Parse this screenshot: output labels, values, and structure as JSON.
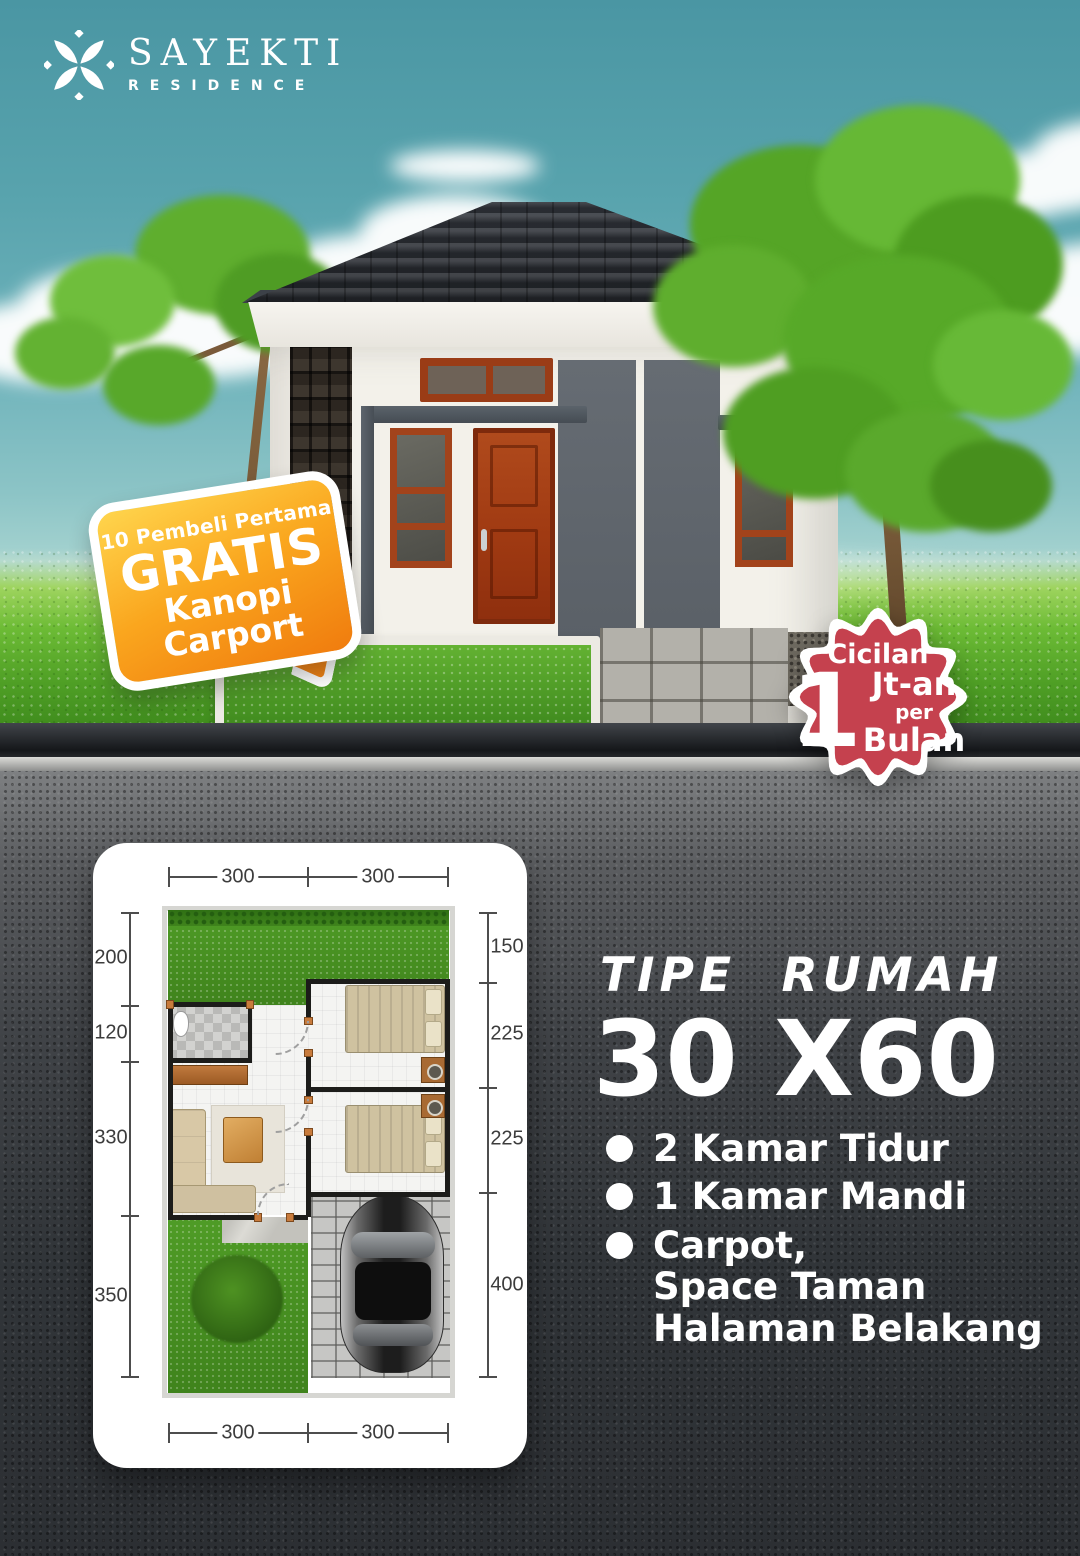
{
  "brand": {
    "name": "SAYEKTI",
    "subtitle": "RESIDENCE"
  },
  "promo_badge": {
    "line1": "10 Pembeli Pertama",
    "line2": "GRATIS",
    "line3": "Kanopi",
    "line4": "Carport"
  },
  "installment_badge": {
    "label": "Cicilan",
    "amount": "1",
    "unit": "Jt-an",
    "per": "per",
    "period": "Bulan"
  },
  "type_info": {
    "heading": "TIPE RUMAH",
    "size": "30 X60",
    "features": [
      "2 Kamar Tidur",
      "1 Kamar Mandi",
      "Carpot,\nSpace Taman\nHalaman Belakang"
    ]
  },
  "floorplan": {
    "dims_top": [
      "300",
      "300"
    ],
    "dims_bottom": [
      "300",
      "300"
    ],
    "dims_left": [
      "200",
      "120",
      "330",
      "350"
    ],
    "dims_right": [
      "150",
      "225",
      "225",
      "400"
    ]
  },
  "colors": {
    "sky_teal": "#5fa8b2",
    "grass_green": "#5aaa2c",
    "asphalt_dark": "#303337",
    "promo_orange": "#f7941d",
    "installment_red": "#c5414e",
    "wood_brown": "#a2431b"
  }
}
